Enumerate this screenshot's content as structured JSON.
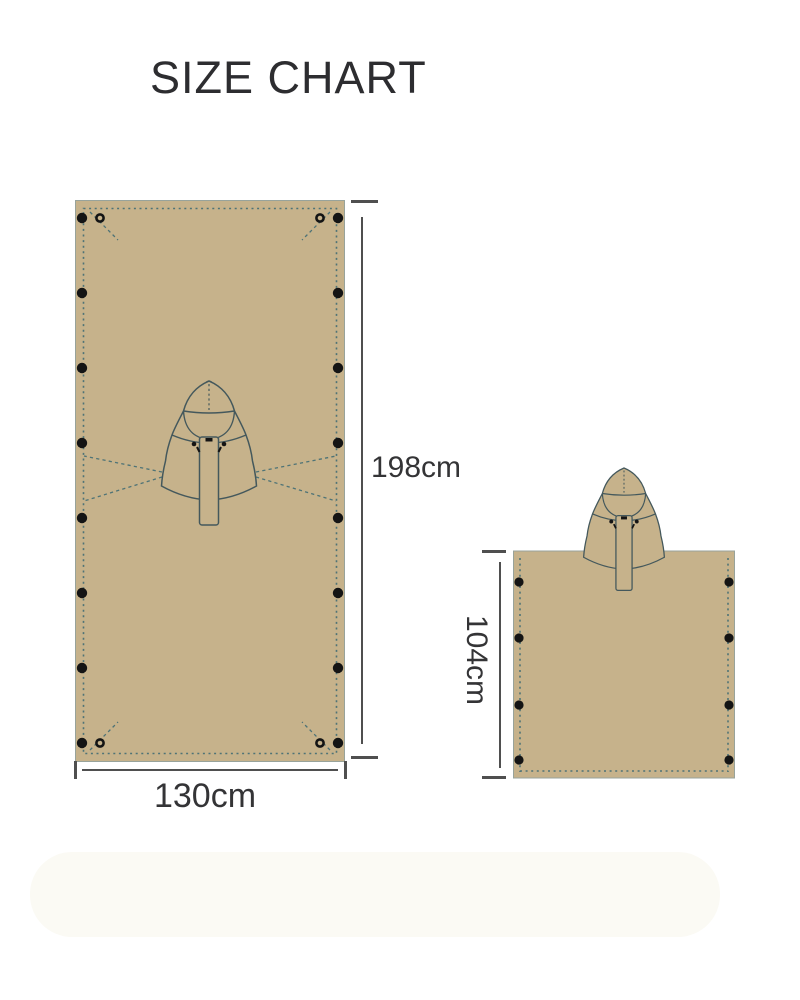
{
  "page": {
    "title": "SIZE CHART"
  },
  "colors": {
    "fabric": "#c6b28b",
    "stitch": "#4e7376",
    "outline": "#44585c",
    "edge": "#98a39b",
    "grommet": "#141414",
    "dimension": "#4f4f4f",
    "label": "#343436",
    "title": "#2d2d30",
    "background": "#ffffff"
  },
  "flat_tarp": {
    "height_label": "198cm",
    "width_label": "130cm",
    "side_grommet_count": 8,
    "corner_ring_grommet_count": 4
  },
  "poncho": {
    "height_label": "104cm",
    "side_grommet_count": 4
  }
}
